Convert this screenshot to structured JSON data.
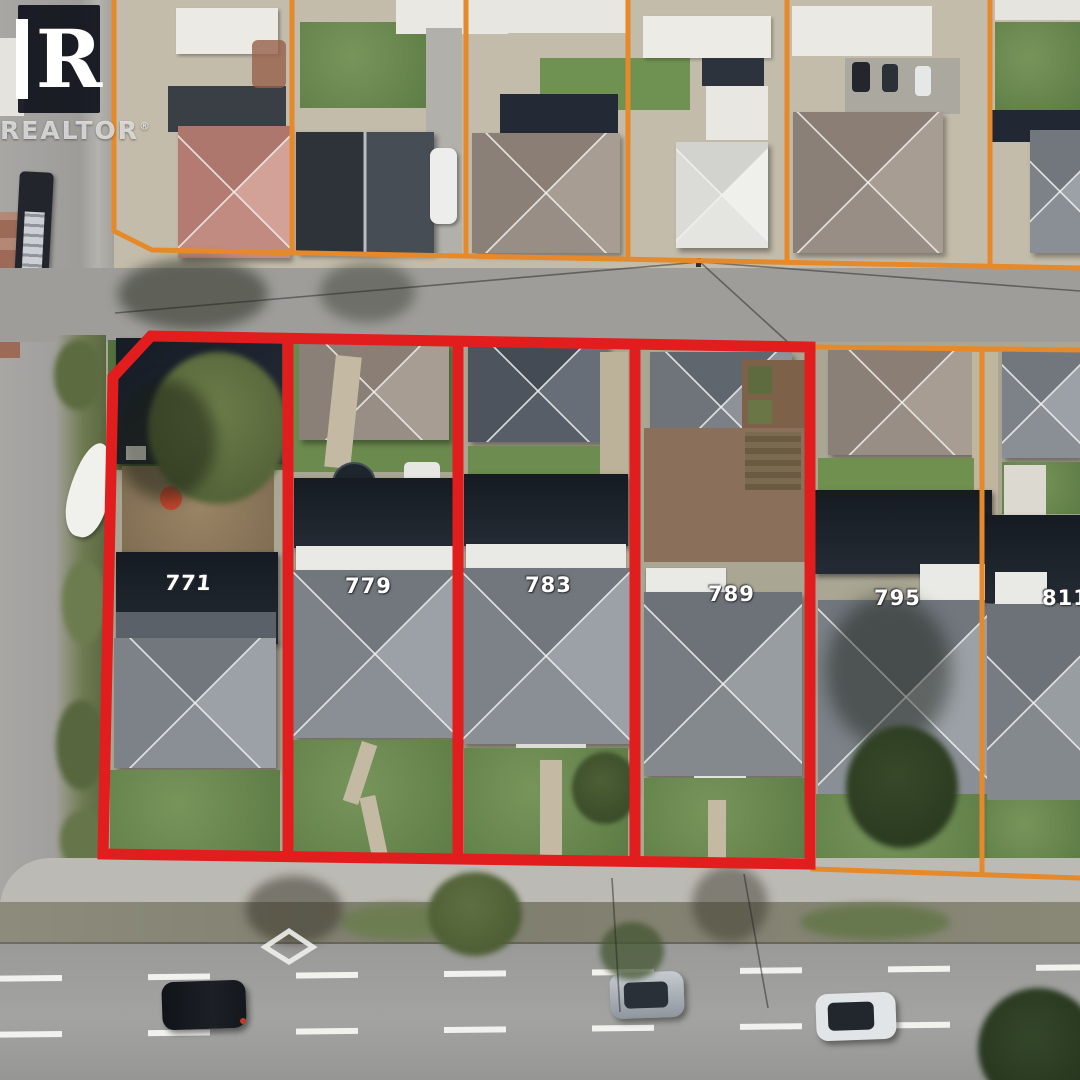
{
  "watermark": {
    "logo_letter": "R",
    "brand": "REALTOR",
    "registered_mark": "®"
  },
  "parcels": {
    "red_outlined": [
      {
        "number": "771"
      },
      {
        "number": "779"
      },
      {
        "number": "783"
      },
      {
        "number": "789"
      }
    ],
    "orange_outlined": [
      {
        "number": "795"
      },
      {
        "number": "811"
      }
    ]
  },
  "colors": {
    "red_outline": "#e21d1d",
    "orange_outline": "#e5892b",
    "road_marking_white": "#f0f0ec"
  }
}
